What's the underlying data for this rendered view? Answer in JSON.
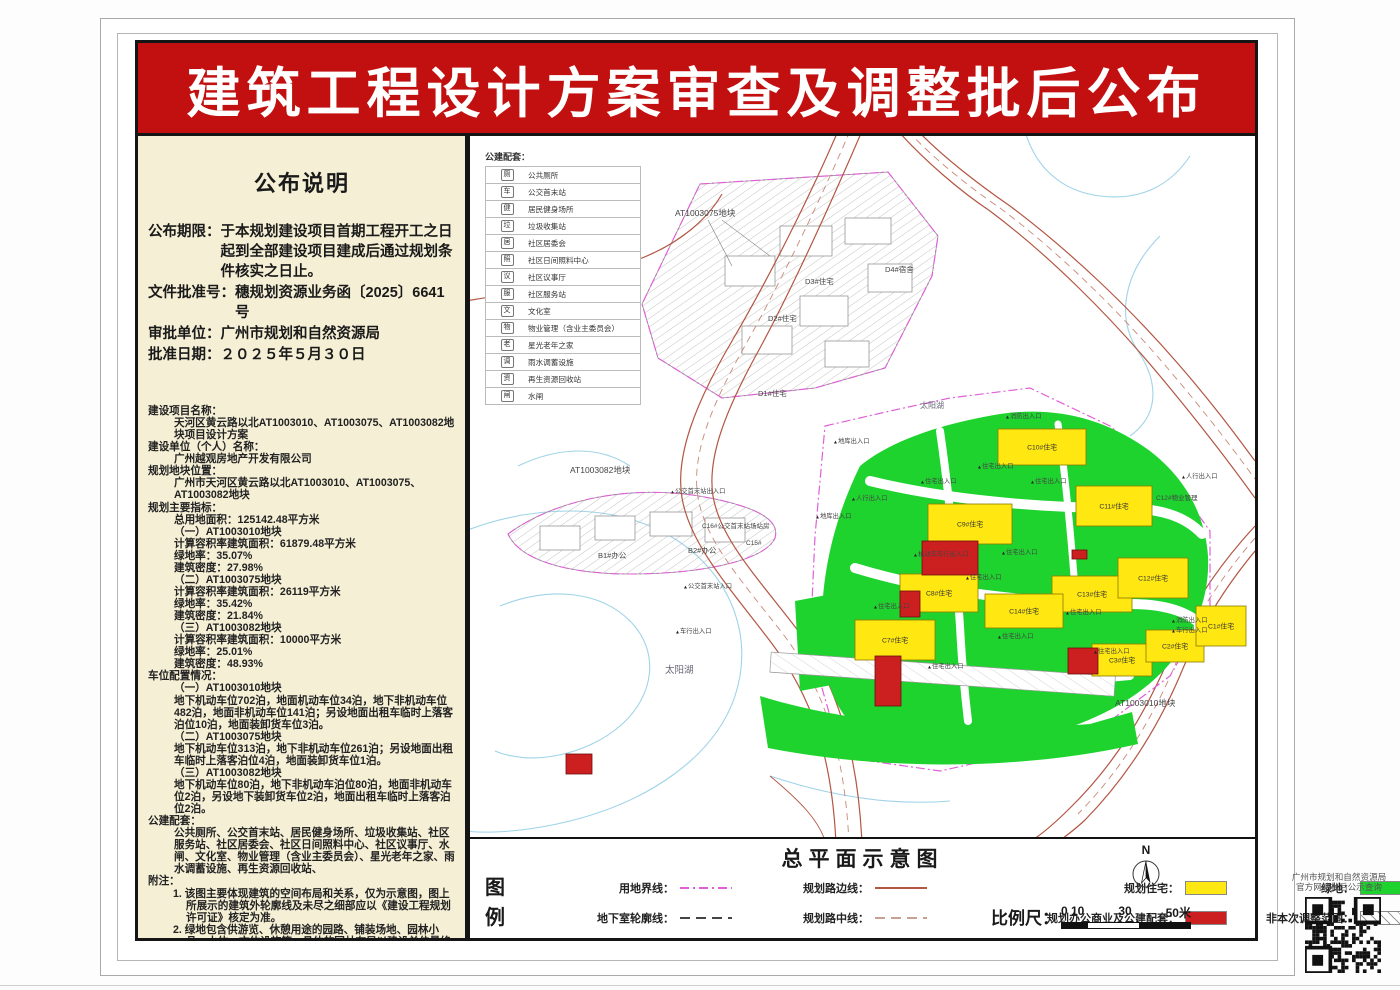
{
  "page": {
    "banner_title": "建筑工程设计方案审查及调整批后公布"
  },
  "left_panel": {
    "title": "公布说明",
    "notice": {
      "period_label": "公布期限：",
      "period_text": "于本规划建设项目首期工程开工之日起到全部建设项目建成后通过规划条件核实之日止。",
      "doc_no_label": "文件批准号：",
      "doc_no": "穗规划资源业务函〔2025〕6641号",
      "authority_label": "审批单位：",
      "authority": "广州市规划和自然资源局",
      "date_label": "批准日期：",
      "date": "２０２５年５月３０日"
    },
    "details": [
      {
        "i": 0,
        "t": "建设项目名称："
      },
      {
        "i": 1,
        "t": "天河区黄云路以北AT1003010、AT1003075、AT1003082地块项目设计方案"
      },
      {
        "i": 0,
        "t": "建设单位（个人）名称："
      },
      {
        "i": 1,
        "t": "广州越观房地产开发有限公司"
      },
      {
        "i": 0,
        "t": "规划地块位置："
      },
      {
        "i": 1,
        "t": "广州市天河区黄云路以北AT1003010、AT1003075、AT1003082地块"
      },
      {
        "i": 0,
        "t": "规划主要指标："
      },
      {
        "i": 1,
        "t": "总用地面积：125142.48平方米"
      },
      {
        "i": 1,
        "t": "（一）AT1003010地块"
      },
      {
        "i": 1,
        "t": "计算容积率建筑面积：61879.48平方米"
      },
      {
        "i": 1,
        "t": "绿地率：35.07%"
      },
      {
        "i": 1,
        "t": "建筑密度：27.98%"
      },
      {
        "i": 1,
        "t": "（二）AT1003075地块"
      },
      {
        "i": 1,
        "t": "计算容积率建筑面积：26119平方米"
      },
      {
        "i": 1,
        "t": "绿地率：35.42%"
      },
      {
        "i": 1,
        "t": "建筑密度：21.84%"
      },
      {
        "i": 1,
        "t": "（三）AT1003082地块"
      },
      {
        "i": 1,
        "t": "计算容积率建筑面积：10000平方米"
      },
      {
        "i": 1,
        "t": "绿地率：25.01%"
      },
      {
        "i": 1,
        "t": "建筑密度：48.93%"
      },
      {
        "i": 0,
        "t": "车位配置情况："
      },
      {
        "i": 1,
        "t": "（一）AT1003010地块"
      },
      {
        "i": 1,
        "t": "地下机动车位702泊，地面机动车位34泊，地下非机动车位482泊，地面非机动车位141泊；另设地面出租车临时上落客泊位10泊，地面装卸货车位3泊。"
      },
      {
        "i": 1,
        "t": "（二）AT1003075地块"
      },
      {
        "i": 1,
        "t": "地下机动车位313泊，地下非机动车位261泊；另设地面出租车临时上落客泊位4泊，地面装卸货车位1泊。"
      },
      {
        "i": 1,
        "t": "（三）AT1003082地块"
      },
      {
        "i": 1,
        "t": "地下机动车位80泊，地下非机动车泊位80泊，地面非机动车位2泊，另设地下装卸货车位2泊，地面出租车临时上落客泊位2泊。"
      },
      {
        "i": 0,
        "t": "公建配套："
      },
      {
        "i": 1,
        "t": "公共厕所、公交首末站、居民健身场所、垃圾收集站、社区服务站、社区居委会、社区日间照料中心、社区议事厅、水闸、文化室、物业管理（含业主委员会）、星光老年之家、雨水调蓄设施、再生资源回收站、"
      },
      {
        "i": 0,
        "t": "附注："
      },
      {
        "i": 2,
        "t": "1. 该图主要体现建筑的空间布局和关系，仅为示意图，图上所展示的建筑外轮廓线及未尽之细部应以《建设工程规划许可证》核定为准。"
      },
      {
        "i": 2,
        "t": "2. 绿地包含供游览、休憩用途的园路、铺装场地、园林小品、水体、文体设施等，具体的园林布局以建设单位最终实施的效果为准。"
      },
      {
        "i": 2,
        "t": "3. 查询网址："
      },
      {
        "i": 3,
        "t": "http://ghzyj.gz.gov.cn/ywpd/cxgh/ghxkgsgb/phgb/gbt/"
      }
    ]
  },
  "map": {
    "pubfac": {
      "title": "公建配套：",
      "items": [
        {
          "icon": "厕",
          "label": "公共厕所"
        },
        {
          "icon": "车",
          "label": "公交首末站"
        },
        {
          "icon": "健",
          "label": "居民健身场所"
        },
        {
          "icon": "垃",
          "label": "垃圾收集站"
        },
        {
          "icon": "居",
          "label": "社区居委会"
        },
        {
          "icon": "照",
          "label": "社区日间照料中心"
        },
        {
          "icon": "议",
          "label": "社区议事厅"
        },
        {
          "icon": "服",
          "label": "社区服务站"
        },
        {
          "icon": "文",
          "label": "文化室"
        },
        {
          "icon": "物",
          "label": "物业管理（含业主委员会）"
        },
        {
          "icon": "老",
          "label": "星光老年之家"
        },
        {
          "icon": "调",
          "label": "雨水调蓄设施"
        },
        {
          "icon": "资",
          "label": "再生资源回收站"
        },
        {
          "icon": "闸",
          "label": "水闸"
        }
      ]
    },
    "buildings": [
      {
        "n": "C10#住宅",
        "x": 528,
        "y": 293,
        "w": 88,
        "h": 36,
        "c": "y"
      },
      {
        "n": "C9#住宅",
        "x": 458,
        "y": 368,
        "w": 84,
        "h": 40,
        "c": "y"
      },
      {
        "n": "C11#住宅",
        "x": 606,
        "y": 350,
        "w": 76,
        "h": 40,
        "c": "y"
      },
      {
        "n": "C13#住宅",
        "x": 582,
        "y": 440,
        "w": 80,
        "h": 36,
        "c": "y"
      },
      {
        "n": "C14#住宅",
        "x": 515,
        "y": 458,
        "w": 78,
        "h": 34,
        "c": "y"
      },
      {
        "n": "C12#住宅",
        "x": 648,
        "y": 422,
        "w": 70,
        "h": 40,
        "c": "y"
      },
      {
        "n": "C8#住宅",
        "x": 430,
        "y": 438,
        "w": 78,
        "h": 38,
        "c": "y"
      },
      {
        "n": "C7#住宅",
        "x": 385,
        "y": 484,
        "w": 80,
        "h": 40,
        "c": "y"
      },
      {
        "n": "C3#住宅",
        "x": 622,
        "y": 508,
        "w": 60,
        "h": 32,
        "c": "y"
      },
      {
        "n": "C2#住宅",
        "x": 676,
        "y": 494,
        "w": 58,
        "h": 32,
        "c": "y"
      },
      {
        "n": "C1#住宅",
        "x": 726,
        "y": 470,
        "w": 50,
        "h": 40,
        "c": "y"
      },
      {
        "n": "",
        "x": 452,
        "y": 405,
        "w": 56,
        "h": 34,
        "c": "r"
      },
      {
        "n": "",
        "x": 430,
        "y": 455,
        "w": 20,
        "h": 26,
        "c": "r"
      },
      {
        "n": "",
        "x": 405,
        "y": 520,
        "w": 26,
        "h": 50,
        "c": "r"
      },
      {
        "n": "",
        "x": 598,
        "y": 512,
        "w": 30,
        "h": 26,
        "c": "r"
      },
      {
        "n": "",
        "x": 602,
        "y": 414,
        "w": 15,
        "h": 9,
        "c": "r"
      },
      {
        "n": "",
        "x": 96,
        "y": 618,
        "w": 26,
        "h": 20,
        "c": "r"
      }
    ],
    "labels": [
      {
        "t": "AT1003075地块",
        "x": 205,
        "y": 80,
        "s": 8.5
      },
      {
        "t": "AT1003082地块",
        "x": 100,
        "y": 337,
        "s": 8.5
      },
      {
        "t": "AT1003010地块",
        "x": 645,
        "y": 570,
        "s": 8.5
      },
      {
        "t": "太阳湖",
        "x": 195,
        "y": 537,
        "s": 9.5,
        "c": "#667"
      },
      {
        "t": "太阳湖",
        "x": 450,
        "y": 272,
        "s": 8,
        "c": "#667"
      },
      {
        "t": "D3#住宅",
        "x": 335,
        "y": 148,
        "s": 7.5
      },
      {
        "t": "D4#宿舍",
        "x": 415,
        "y": 136,
        "s": 7.5
      },
      {
        "t": "D2#住宅",
        "x": 298,
        "y": 185,
        "s": 7.5
      },
      {
        "t": "D1#住宅",
        "x": 288,
        "y": 260,
        "s": 7.5
      },
      {
        "t": "B2#办公",
        "x": 218,
        "y": 417,
        "s": 7.5
      },
      {
        "t": "B1#办公",
        "x": 128,
        "y": 422,
        "s": 7.5
      },
      {
        "t": "C16#公交首末站场站房",
        "x": 232,
        "y": 392,
        "s": 6.5
      },
      {
        "t": "C15#",
        "x": 276,
        "y": 409,
        "s": 6.5
      },
      {
        "t": "C12#物业管理",
        "x": 686,
        "y": 364,
        "s": 6.5
      },
      {
        "t": "地库出入口",
        "x": 368,
        "y": 307,
        "m": 1
      },
      {
        "t": "人行出入口",
        "x": 386,
        "y": 364,
        "m": 1
      },
      {
        "t": "地库出入口",
        "x": 350,
        "y": 382,
        "m": 1
      },
      {
        "t": "消防出入口",
        "x": 540,
        "y": 282,
        "m": 1
      },
      {
        "t": "人行出入口",
        "x": 716,
        "y": 342,
        "m": 1
      },
      {
        "t": "消防出入口",
        "x": 706,
        "y": 486,
        "m": 1
      },
      {
        "t": "车行出入口",
        "x": 706,
        "y": 496,
        "m": 1
      },
      {
        "t": "住宅出入口",
        "x": 455,
        "y": 347,
        "m": 1
      },
      {
        "t": "住宅出入口",
        "x": 512,
        "y": 332,
        "m": 1
      },
      {
        "t": "住宅出入口",
        "x": 565,
        "y": 347,
        "m": 1
      },
      {
        "t": "住宅出入口",
        "x": 536,
        "y": 418,
        "m": 1
      },
      {
        "t": "住宅出入口",
        "x": 500,
        "y": 443,
        "m": 1
      },
      {
        "t": "住宅出入口",
        "x": 408,
        "y": 472,
        "m": 1
      },
      {
        "t": "住宅出入口",
        "x": 462,
        "y": 532,
        "m": 1
      },
      {
        "t": "住宅出入口",
        "x": 532,
        "y": 502,
        "m": 1
      },
      {
        "t": "住宅出入口",
        "x": 600,
        "y": 478,
        "m": 1
      },
      {
        "t": "住宅出入口",
        "x": 628,
        "y": 517,
        "m": 1
      },
      {
        "t": "机动车车行出入口",
        "x": 448,
        "y": 420,
        "m": 1
      },
      {
        "t": "公交首末站出入口",
        "x": 205,
        "y": 357,
        "m": 1
      },
      {
        "t": "公交首末站入口",
        "x": 218,
        "y": 452,
        "m": 1
      },
      {
        "t": "车行出入口",
        "x": 210,
        "y": 497,
        "m": 1
      }
    ]
  },
  "footer": {
    "title": "总平面示意图",
    "legend_word": "图例",
    "items": [
      {
        "label": "用地界线：",
        "type": "dashdot-magenta"
      },
      {
        "label": "地下室轮廓线：",
        "type": "dash-dark"
      },
      {
        "label": "规划路边线：",
        "type": "solid-brown"
      },
      {
        "label": "规划路中线：",
        "type": "dash-light"
      },
      {
        "label": "规划住宅：",
        "type": "yellow-box"
      },
      {
        "label": "规划办公商业及公建配套：",
        "type": "red-box"
      },
      {
        "label": "绿地：",
        "type": "green-box"
      },
      {
        "label": "非本次调整范围：",
        "type": "hatch-box"
      }
    ],
    "north_label": "N",
    "scale_label": "比例尺：",
    "scale_ticks": [
      "0 10",
      "30",
      "50米"
    ]
  },
  "qr": {
    "caption_line1": "广州市规划和自然资源局",
    "caption_line2": "官方网站批后公示查询"
  },
  "colors": {
    "banner_red": "#c21010",
    "panel_beige": "#f4efd5",
    "residential_yellow": "#ffe712",
    "green_space": "#1fd32f",
    "office_red": "#cc2020",
    "boundary_magenta": "#e05fd8",
    "road_brown": "#b35643",
    "water_blue": "#9fd3e8"
  }
}
